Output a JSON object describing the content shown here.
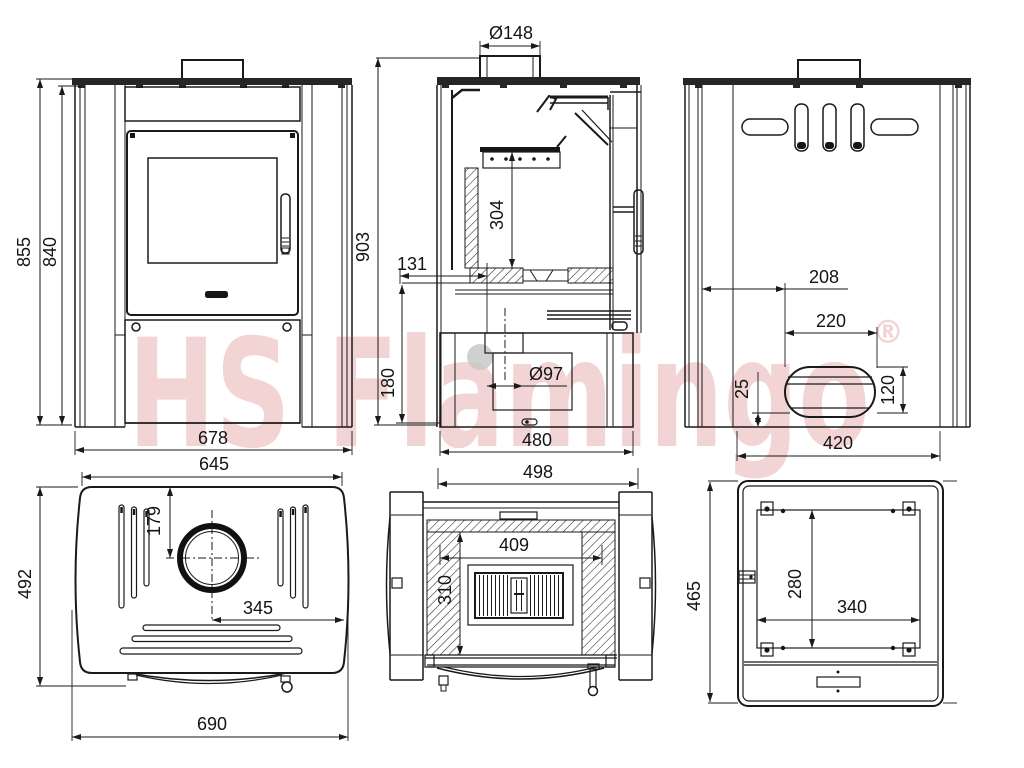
{
  "watermark": {
    "text": "HS Flamingo",
    "registered": "®"
  },
  "colors": {
    "line": "#1a1a1a",
    "plate": "#262626",
    "watermark": "#f3d4d4",
    "gray_dot": "#c8c8c8"
  },
  "views": {
    "front": {
      "height_total": "855",
      "height_body": "840",
      "width_body": "678"
    },
    "side_section": {
      "flue_diameter": "Ø148",
      "height_total": "903",
      "firebox_height": "304",
      "inlet_offset": "131",
      "inlet_bottom_height": "180",
      "inlet_diameter": "Ø97",
      "base_depth": "480",
      "depth_total": "498"
    },
    "rear": {
      "outlet_offset_left": "208",
      "outlet_width": "220",
      "outlet_bottom": "25",
      "outlet_height": "120",
      "rear_width": "420"
    },
    "top": {
      "top_width": "645",
      "flue_center_from_rear": "179",
      "depth": "492",
      "flue_center_to_side": "345",
      "max_width": "690"
    },
    "top_section": {
      "firebox_width": "409",
      "firebox_depth": "310"
    },
    "bottom": {
      "depth": "465",
      "inner_depth": "280",
      "inner_width": "340"
    }
  }
}
